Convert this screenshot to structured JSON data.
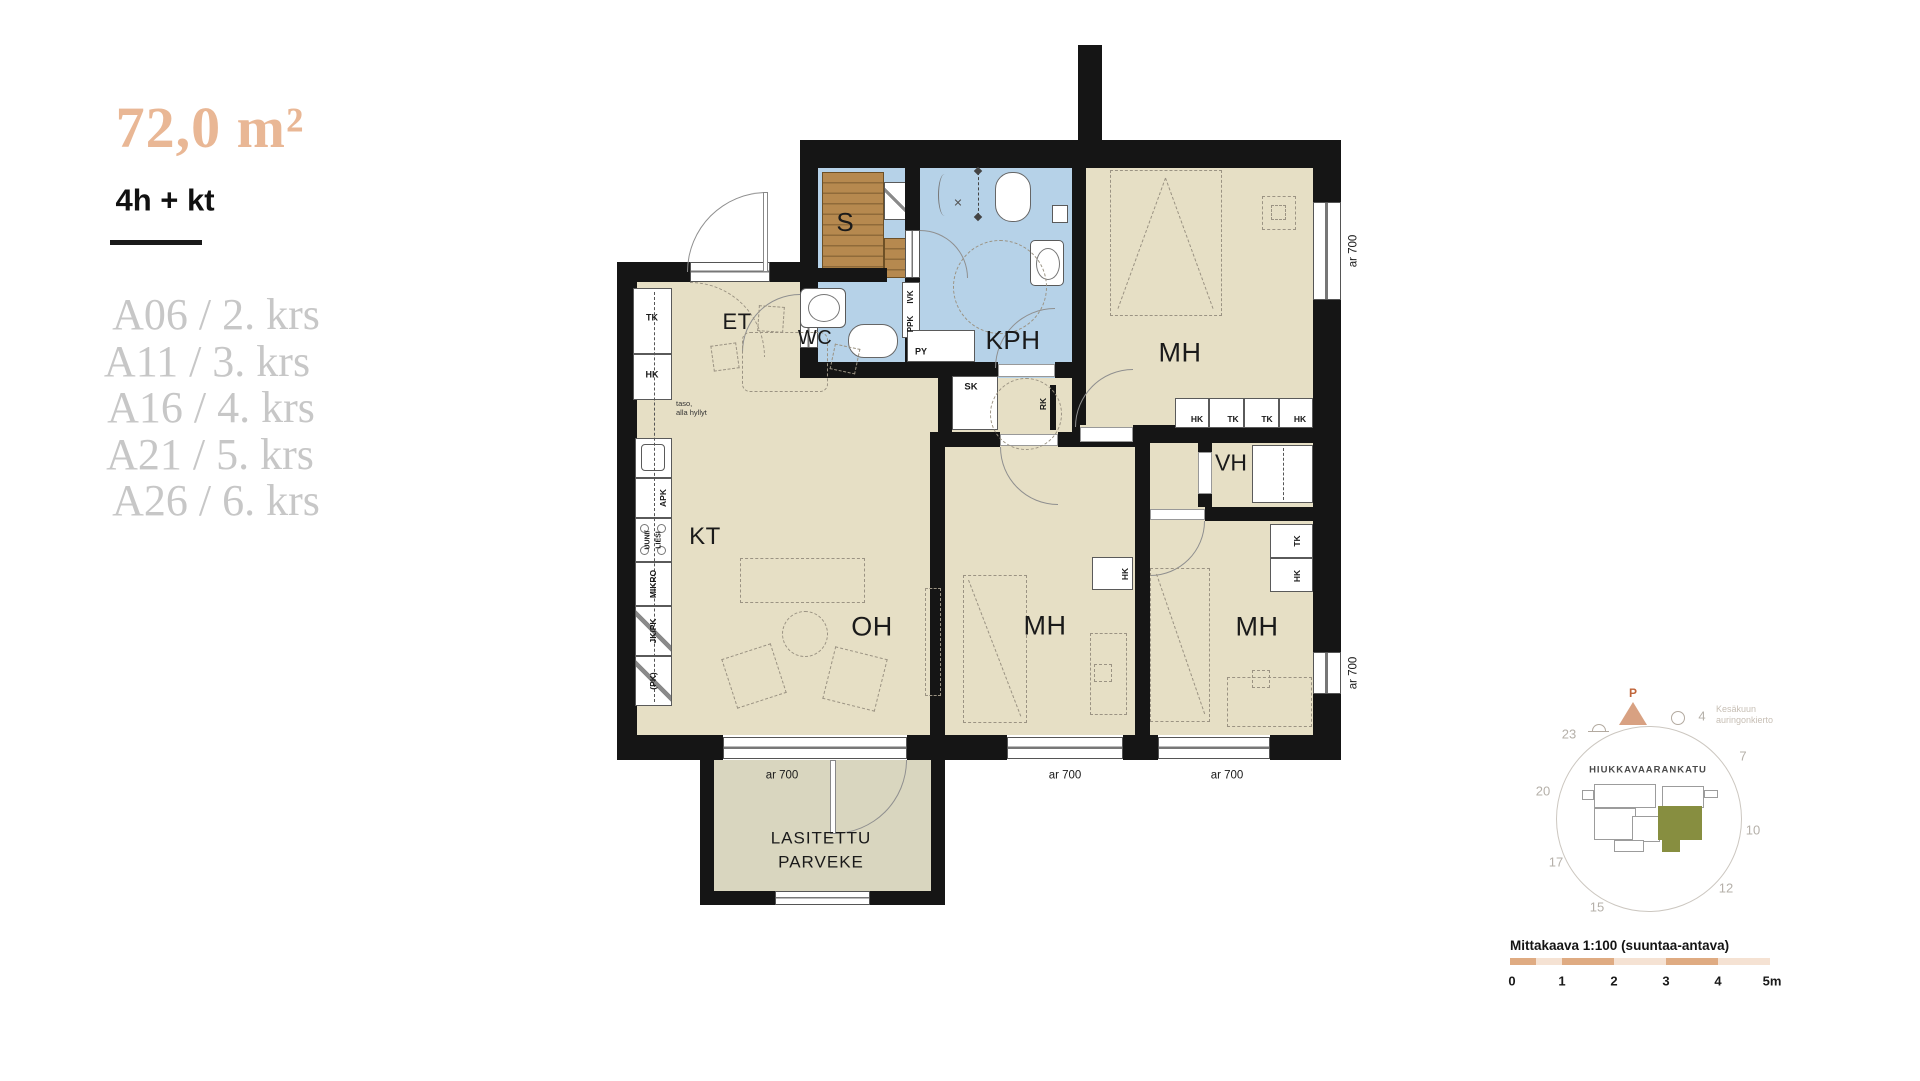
{
  "panel": {
    "area": "72,0 m²",
    "type": "4h + kt",
    "units": [
      "A06 / 2. krs",
      "A11 / 3. krs",
      "A16 / 4. krs",
      "A21 / 5. krs",
      "A26 / 6. krs"
    ]
  },
  "plan": {
    "rooms": {
      "et": "ET",
      "wc": "WC",
      "kph": "KPH",
      "s": "S",
      "mh": "MH",
      "vh": "VH",
      "kt": "KT",
      "oh": "OH"
    },
    "balcony": {
      "line1": "LASITETTU",
      "line2": "PARVEKE"
    },
    "fixtures": {
      "sk": "SK",
      "rk": "RK",
      "py": "PY",
      "ppk": "PPK",
      "ivk": "IVK",
      "tk": "TK",
      "hk": "HK",
      "apk": "APK",
      "uuni": "UUNI/",
      "liesi": "LIESI",
      "mikro": "MIKRO",
      "jkpk": "JK/PK",
      "pk": "(PK)",
      "taso1": "taso,",
      "taso2": "alla hyllyt"
    },
    "window_note": "ar 700"
  },
  "compass": {
    "north": "P",
    "street": "HIUKKAVAARANKATU",
    "note1": "Kesäkuun",
    "note2": "auringonkierto",
    "hours": [
      "4",
      "7",
      "10",
      "12",
      "15",
      "17",
      "20",
      "23"
    ]
  },
  "scale": {
    "title": "Mittakaava 1:100 (suuntaa-antava)",
    "ticks": [
      "0",
      "1",
      "2",
      "3",
      "4",
      "5m"
    ]
  },
  "colors": {
    "accent": "#e9b795",
    "room": "#e6dfc5",
    "wet": "#b6d2e8",
    "wood": "#b6894f",
    "balcony": "#d9d6bf",
    "wall": "#151515",
    "muted": "#c7c7c7",
    "olive": "#878e40",
    "scale_dark": "#dfab82",
    "scale_light": "#f5e2d3"
  }
}
